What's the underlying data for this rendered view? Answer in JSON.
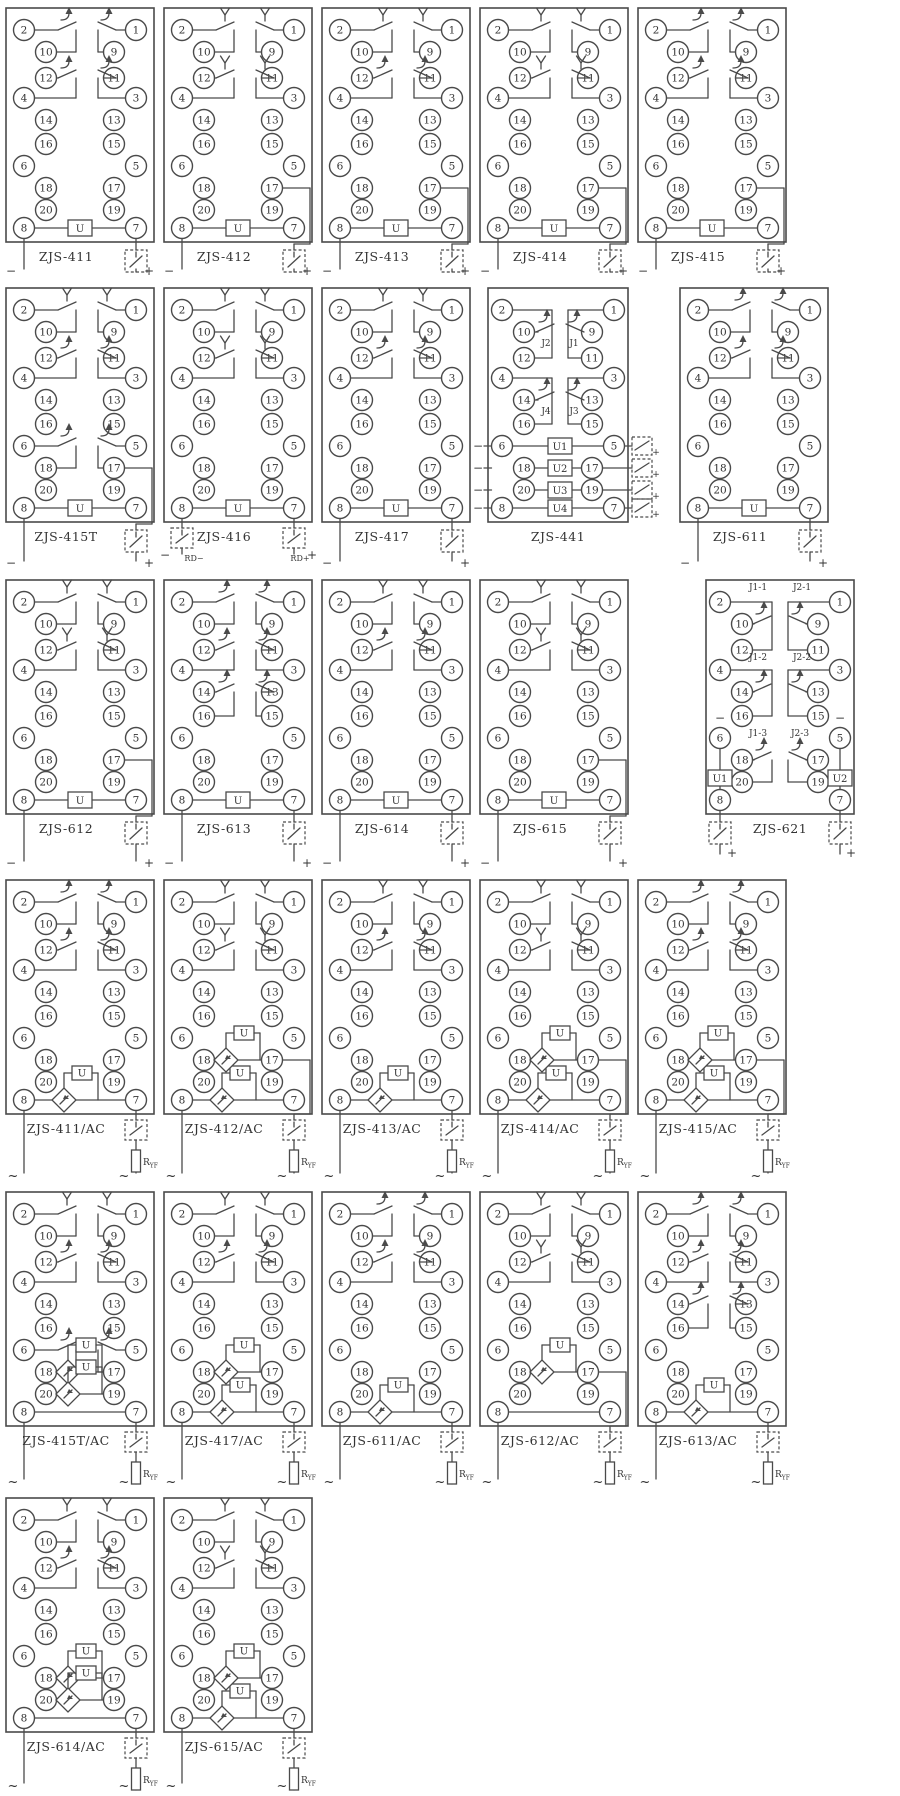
{
  "shared": {
    "rows_left": [
      "2",
      "10",
      "12",
      "4",
      "14",
      "16",
      "6",
      "18",
      "20",
      "8"
    ],
    "rows_right": [
      "1",
      "9",
      "11",
      "3",
      "13",
      "15",
      "5",
      "17",
      "19",
      "7"
    ],
    "coil_label": "U",
    "resistor_label": "R",
    "resistor_sub": "YF",
    "minus": "−",
    "plus": "+",
    "ac": "~",
    "line_color": "#4a4a4a"
  },
  "units": [
    {
      "label": "ZJS-411",
      "type": "dc",
      "contacts": [
        {
          "pair": 1,
          "style": "arrow"
        },
        {
          "pair": 2,
          "style": "arrow"
        }
      ],
      "out": "7"
    },
    {
      "label": "ZJS-412",
      "type": "dc",
      "contacts": [
        {
          "pair": 1,
          "style": "fork"
        },
        {
          "pair": 2,
          "style": "fork"
        }
      ],
      "out": "17"
    },
    {
      "label": "ZJS-413",
      "type": "dc",
      "contacts": [
        {
          "pair": 1,
          "style": "fork"
        },
        {
          "pair": 2,
          "style": "arrow"
        }
      ],
      "out": "17"
    },
    {
      "label": "ZJS-414",
      "type": "dc",
      "contacts": [
        {
          "pair": 1,
          "style": "fork"
        },
        {
          "pair": 2,
          "style": "fork"
        }
      ],
      "out": "17"
    },
    {
      "label": "ZJS-415",
      "type": "dc",
      "contacts": [
        {
          "pair": 1,
          "style": "arrow"
        },
        {
          "pair": 2,
          "style": "arrow"
        }
      ],
      "out": "17"
    },
    {
      "label": "ZJS-415T",
      "type": "dc",
      "contacts": [
        {
          "pair": 1,
          "style": "fork"
        },
        {
          "pair": 2,
          "style": "arrow"
        },
        {
          "pair": 4,
          "style": "arrow"
        }
      ],
      "out": "17"
    },
    {
      "label": "ZJS-416",
      "type": "dc",
      "contacts": [
        {
          "pair": 1,
          "style": "fork"
        },
        {
          "pair": 2,
          "style": "fork"
        }
      ],
      "out": "rd",
      "out_labels": [
        "RD−",
        "RD+"
      ]
    },
    {
      "label": "ZJS-417",
      "type": "dc",
      "contacts": [
        {
          "pair": 1,
          "style": "fork"
        },
        {
          "pair": 2,
          "style": "arrow"
        }
      ],
      "out": "7"
    },
    {
      "label": "ZJS-441",
      "type": "m441",
      "contact_labels": [
        "J2",
        "J1",
        "J4",
        "J3"
      ],
      "coils": [
        "U1",
        "U2",
        "U3",
        "U4"
      ]
    },
    {
      "label": "ZJS-611",
      "type": "dc",
      "contacts": [
        {
          "pair": 1,
          "style": "arrow"
        },
        {
          "pair": 2,
          "style": "arrow"
        }
      ],
      "out": "7"
    },
    {
      "label": "ZJS-612",
      "type": "dc",
      "contacts": [
        {
          "pair": 1,
          "style": "fork"
        },
        {
          "pair": 2,
          "style": "fork"
        }
      ],
      "out": "17"
    },
    {
      "label": "ZJS-613",
      "type": "dc",
      "contacts": [
        {
          "pair": 1,
          "style": "arrow"
        },
        {
          "pair": 2,
          "style": "arrow"
        },
        {
          "pair": 3,
          "style": "arrow"
        }
      ],
      "out": "7"
    },
    {
      "label": "ZJS-614",
      "type": "dc",
      "contacts": [
        {
          "pair": 1,
          "style": "fork"
        },
        {
          "pair": 2,
          "style": "arrow"
        }
      ],
      "out": "7"
    },
    {
      "label": "ZJS-615",
      "type": "dc",
      "contacts": [
        {
          "pair": 1,
          "style": "fork"
        },
        {
          "pair": 2,
          "style": "fork"
        }
      ],
      "out": "17"
    },
    {
      "label": "ZJS-621",
      "type": "m621",
      "contact_labels": [
        [
          "J1-1",
          "J2-1"
        ],
        [
          "J1-2",
          "J2-2"
        ],
        [
          "J1-3",
          "J2-3"
        ]
      ],
      "coils": [
        "U1",
        "U2"
      ]
    },
    {
      "label": "ZJS-411/AC",
      "type": "ac",
      "contacts": [
        {
          "pair": 1,
          "style": "arrow"
        },
        {
          "pair": 2,
          "style": "arrow"
        }
      ],
      "diamonds": [
        9
      ],
      "out": "7"
    },
    {
      "label": "ZJS-412/AC",
      "type": "ac",
      "contacts": [
        {
          "pair": 1,
          "style": "fork"
        },
        {
          "pair": 2,
          "style": "fork"
        }
      ],
      "diamonds": [
        7,
        9
      ],
      "out": "17"
    },
    {
      "label": "ZJS-413/AC",
      "type": "ac",
      "contacts": [
        {
          "pair": 1,
          "style": "fork"
        },
        {
          "pair": 2,
          "style": "arrow"
        }
      ],
      "diamonds": [
        9
      ],
      "out": "7"
    },
    {
      "label": "ZJS-414/AC",
      "type": "ac",
      "contacts": [
        {
          "pair": 1,
          "style": "fork"
        },
        {
          "pair": 2,
          "style": "fork"
        }
      ],
      "diamonds": [
        7,
        9
      ],
      "out": "17"
    },
    {
      "label": "ZJS-415/AC",
      "type": "ac",
      "contacts": [
        {
          "pair": 1,
          "style": "arrow"
        },
        {
          "pair": 2,
          "style": "arrow"
        }
      ],
      "diamonds": [
        7,
        9
      ],
      "out": "17"
    },
    {
      "label": "ZJS-415T/AC",
      "type": "ac",
      "contacts": [
        {
          "pair": 1,
          "style": "fork"
        },
        {
          "pair": 2,
          "style": "arrow"
        },
        {
          "pair": 4,
          "style": "arrow"
        }
      ],
      "diamonds": [
        7,
        8
      ],
      "out": "7"
    },
    {
      "label": "ZJS-417/AC",
      "type": "ac",
      "contacts": [
        {
          "pair": 1,
          "style": "fork"
        },
        {
          "pair": 2,
          "style": "arrow"
        }
      ],
      "diamonds": [
        7,
        9
      ],
      "out": "7"
    },
    {
      "label": "ZJS-611/AC",
      "type": "ac",
      "contacts": [
        {
          "pair": 1,
          "style": "arrow"
        },
        {
          "pair": 2,
          "style": "arrow"
        }
      ],
      "diamonds": [
        9
      ],
      "out": "7"
    },
    {
      "label": "ZJS-612/AC",
      "type": "ac",
      "contacts": [
        {
          "pair": 1,
          "style": "fork"
        },
        {
          "pair": 2,
          "style": "fork"
        }
      ],
      "diamonds": [
        7
      ],
      "out": "17"
    },
    {
      "label": "ZJS-613/AC",
      "type": "ac",
      "contacts": [
        {
          "pair": 1,
          "style": "arrow"
        },
        {
          "pair": 2,
          "style": "arrow"
        },
        {
          "pair": 3,
          "style": "arrow"
        }
      ],
      "diamonds": [
        9
      ],
      "out": "7"
    },
    {
      "label": "ZJS-614/AC",
      "type": "ac",
      "contacts": [
        {
          "pair": 1,
          "style": "fork"
        },
        {
          "pair": 2,
          "style": "arrow"
        }
      ],
      "diamonds": [
        7,
        8
      ],
      "out": "7"
    },
    {
      "label": "ZJS-615/AC",
      "type": "ac",
      "contacts": [
        {
          "pair": 1,
          "style": "fork"
        },
        {
          "pair": 2,
          "style": "fork"
        }
      ],
      "diamonds": [
        7,
        9
      ],
      "out": "7"
    }
  ]
}
